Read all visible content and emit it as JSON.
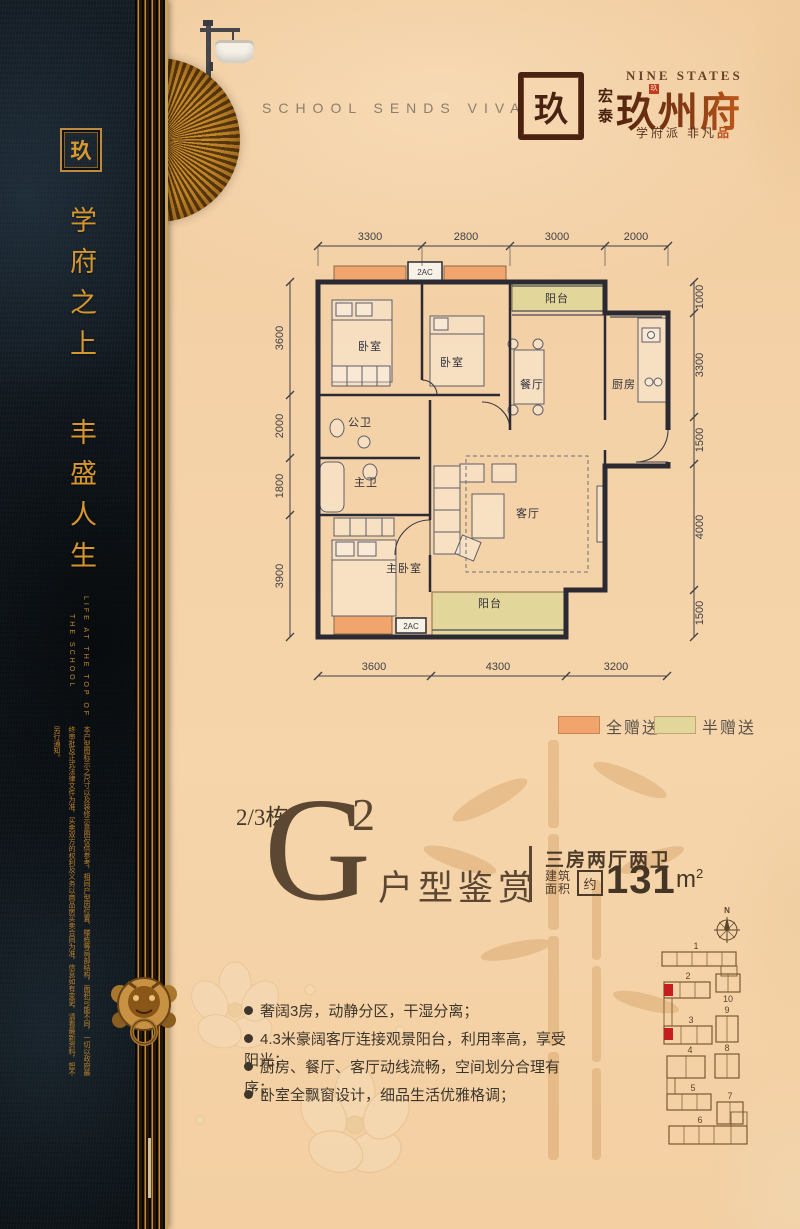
{
  "brand": {
    "header_en": "SCHOOL SENDS VIVA",
    "seal_char": "玖",
    "name_en": "NINE STATES",
    "prefix": "宏泰",
    "name_cn": "玖州府",
    "tagline_1": "学府派 非凡",
    "tagline_accent": "品"
  },
  "sidebar": {
    "seal_char": "玖",
    "slogan": [
      "学府之上",
      "丰盛人生"
    ],
    "slogan_en": [
      "LIFE AT THE TOP OF",
      "THE SCHOOL"
    ],
    "disclaimer": "本户型图标示之尺寸以及装修示意图仅供参考，相同户型因位置、楼栋等局部结构，面积可能不同，一切以政府最终审批及正式法律文件为准，买卖双方的权利及义务以商品房买卖合同为准，信息如有变更，请看最新资料，恕不另行通知。"
  },
  "floorplan": {
    "dims_top": [
      "3300",
      "2800",
      "3000",
      "2000"
    ],
    "dims_left": [
      "3600",
      "2000",
      "1800",
      "3900"
    ],
    "dims_right": [
      "1000",
      "3300",
      "1500",
      "4000",
      "1500"
    ],
    "dims_bottom": [
      "3600",
      "4300",
      "3200"
    ],
    "rooms": {
      "bedroom1": "卧室",
      "bedroom2": "卧室",
      "balcony_top": "阳台",
      "dining": "餐厅",
      "kitchen": "厨房",
      "bath": "公卫",
      "master_bath": "主卫",
      "master_bedroom": "主卧室",
      "living": "客厅",
      "balcony_bottom": "阳台"
    },
    "ac_label": "2AC",
    "colors": {
      "full_gift": "#f1a46c",
      "half_gift": "#e3d69b",
      "wall": "#2b2a33"
    },
    "legend": [
      {
        "label": "全赠送"
      },
      {
        "label": "半赠送"
      }
    ]
  },
  "unit": {
    "building": "2/3栋",
    "type_letter": "G",
    "type_sup": "2",
    "title_suffix": "户型鉴赏",
    "layout": "三房两厅两卫",
    "area_label_top": "建筑",
    "area_label_bottom": "面积",
    "approx": "约",
    "area_value": "131",
    "area_unit": "m",
    "area_unit_sup": "2"
  },
  "features": [
    "奢阔3房，动静分区，干湿分离；",
    "4.3米豪阔客厅连接观景阳台，利用率高，享受阳光；",
    "厨房、餐厅、客厅动线流畅，空间划分合理有序；",
    "卧室全飘窗设计，细品生活优雅格调；"
  ],
  "siteplan": {
    "north_label": "N",
    "building_labels": [
      "1",
      "2",
      "3",
      "4",
      "5",
      "6",
      "7",
      "8",
      "9",
      "10"
    ],
    "highlight_color": "#c41e1e"
  }
}
